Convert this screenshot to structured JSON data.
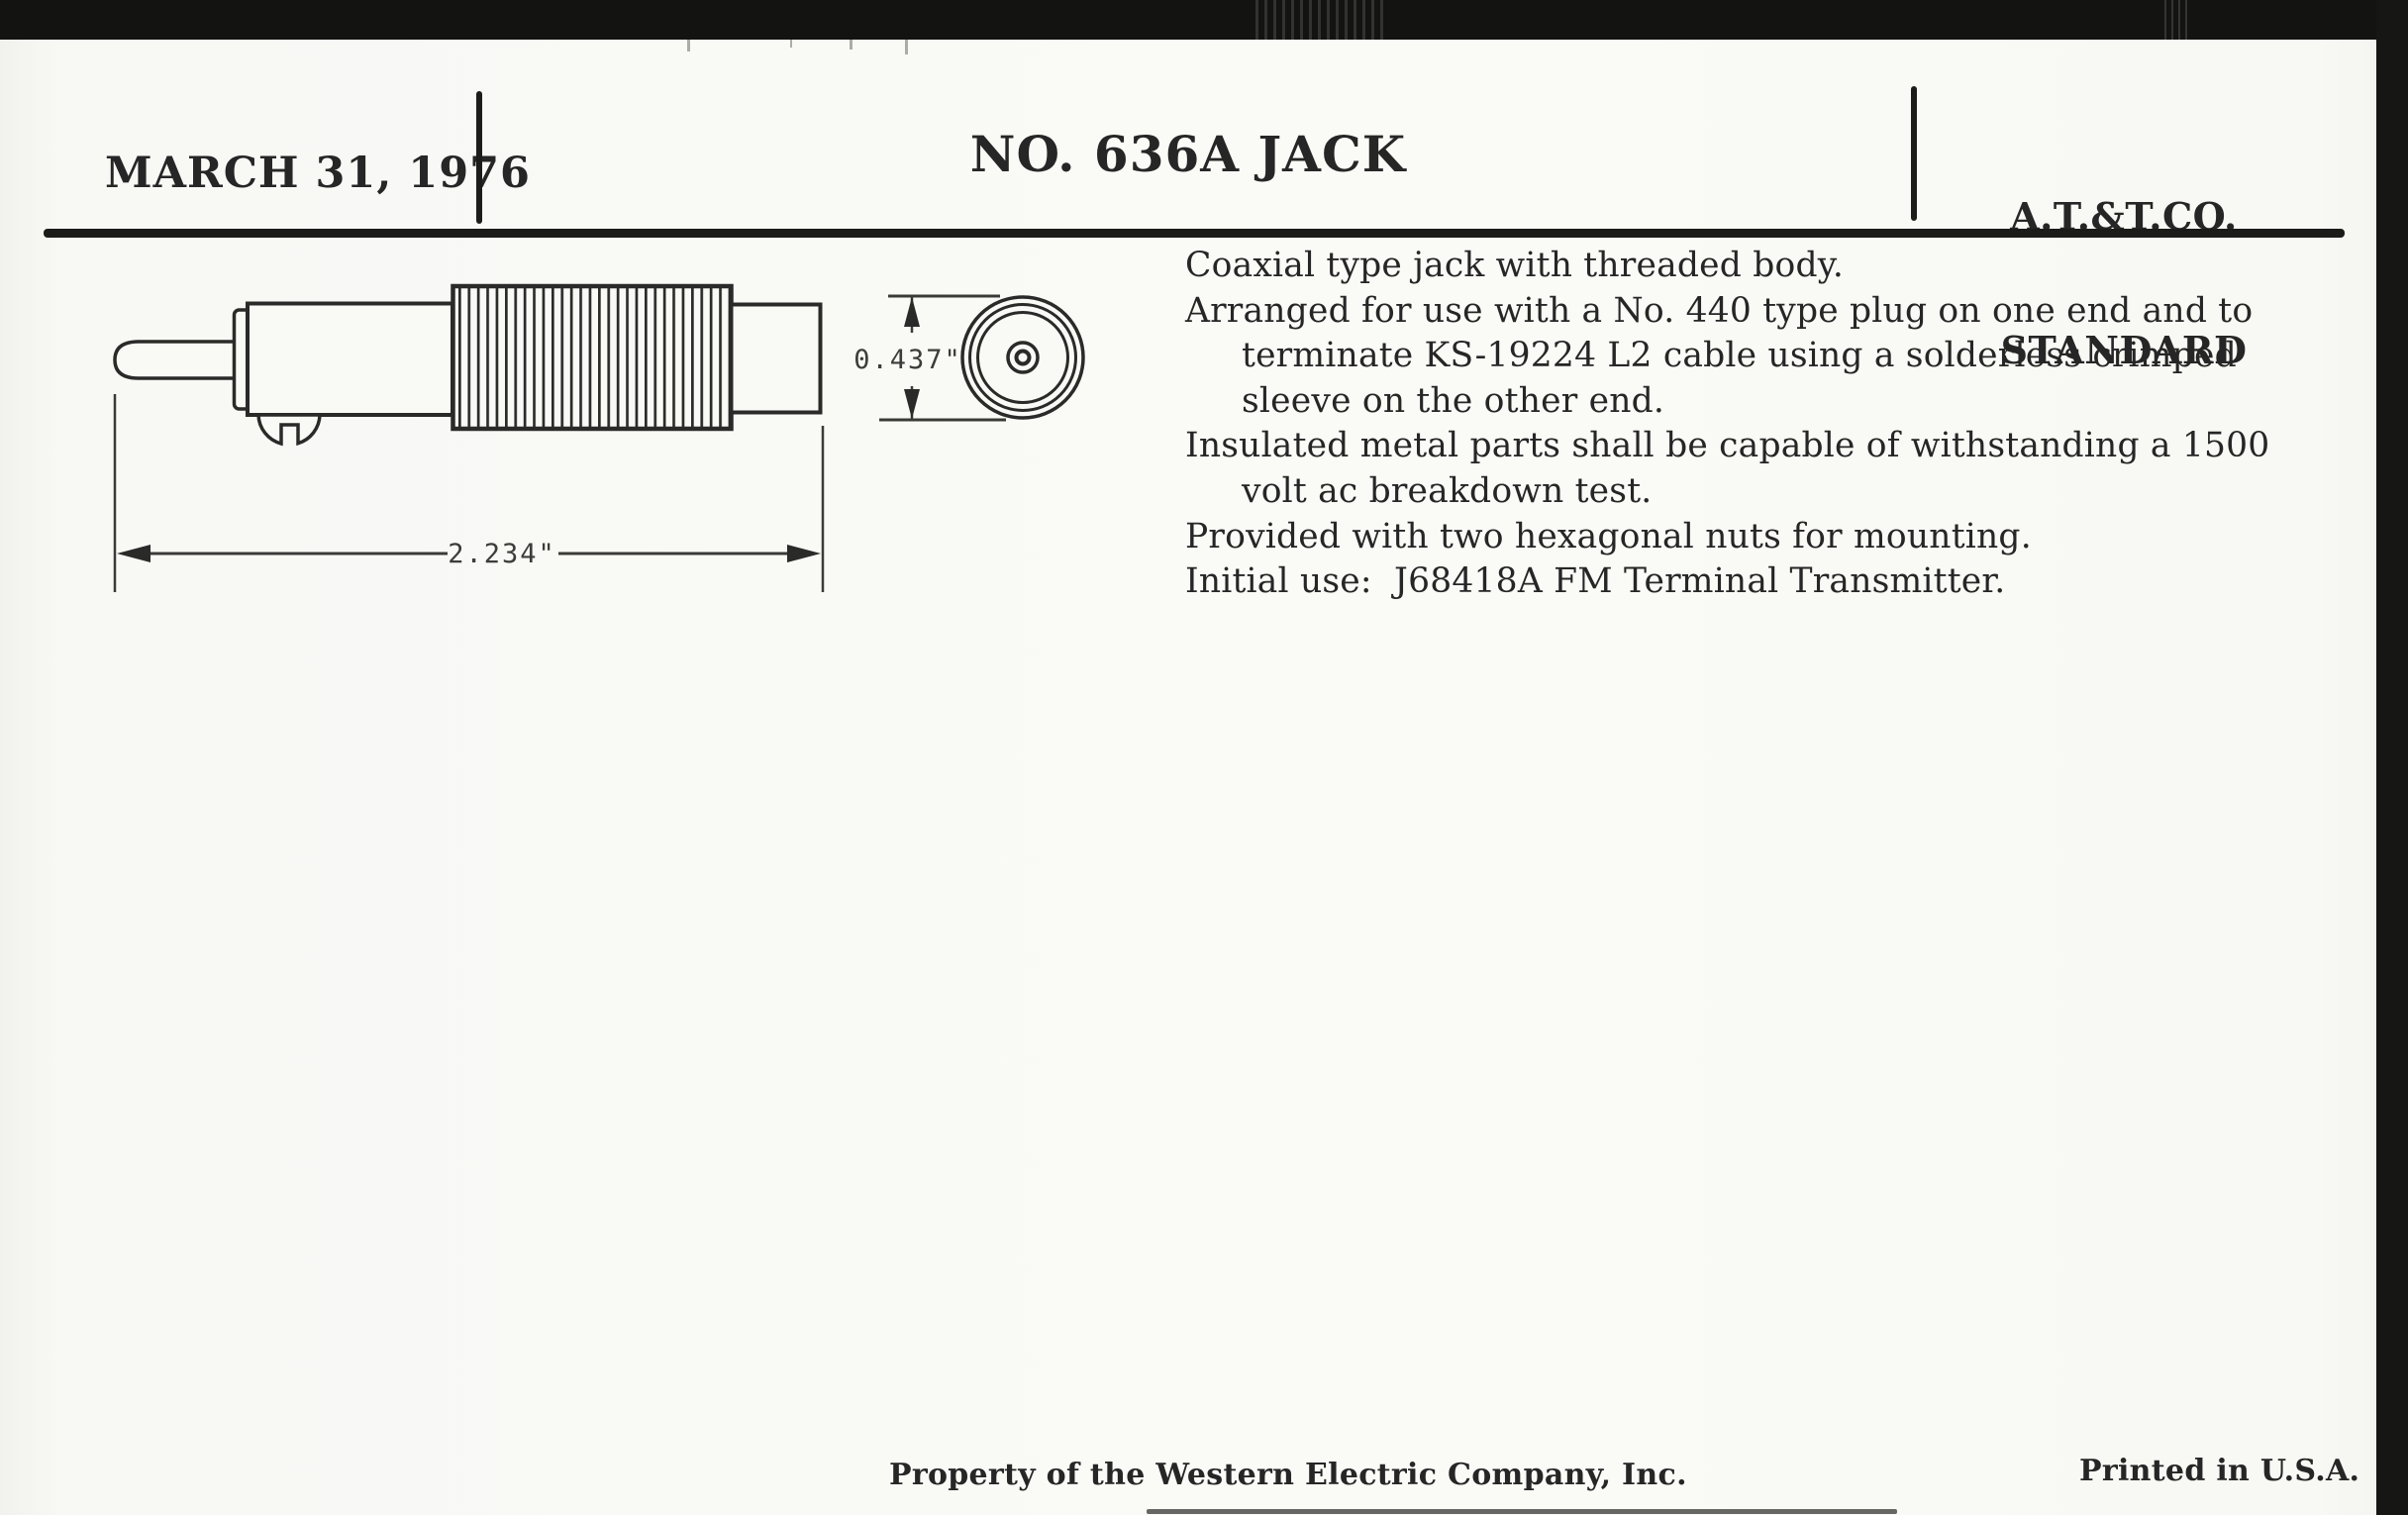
{
  "page": {
    "header": {
      "date": "MARCH 31, 1976",
      "title": "NO. 636A JACK",
      "org_line1": "A.T.&T.CO.",
      "org_line2": "STANDARD"
    },
    "drawing": {
      "length_dimension": "2.234\"",
      "diameter_dimension": "0.437\""
    },
    "description": {
      "lines": [
        {
          "text": "Coaxial type jack with threaded body.",
          "indent": false
        },
        {
          "text": "Arranged for use with a No. 440 type plug on one end and to",
          "indent": false
        },
        {
          "text": "terminate KS-19224 L2 cable using a solderless crimped",
          "indent": true
        },
        {
          "text": "sleeve on the other end.",
          "indent": true
        },
        {
          "text": "Insulated metal parts shall be capable of withstanding a 1500",
          "indent": false
        },
        {
          "text": "volt ac breakdown test.",
          "indent": true
        },
        {
          "text": "Provided with two hexagonal nuts for mounting.",
          "indent": false
        },
        {
          "text": "Initial use:  J68418A FM Terminal Transmitter.",
          "indent": false
        }
      ]
    },
    "footer": {
      "left": "Property of the Western Electric Company, Inc.",
      "right": "Printed in U.S.A."
    },
    "colors": {
      "ink": "#262626",
      "paper": "#f9f9f6",
      "scanner_black": "#141413"
    }
  }
}
